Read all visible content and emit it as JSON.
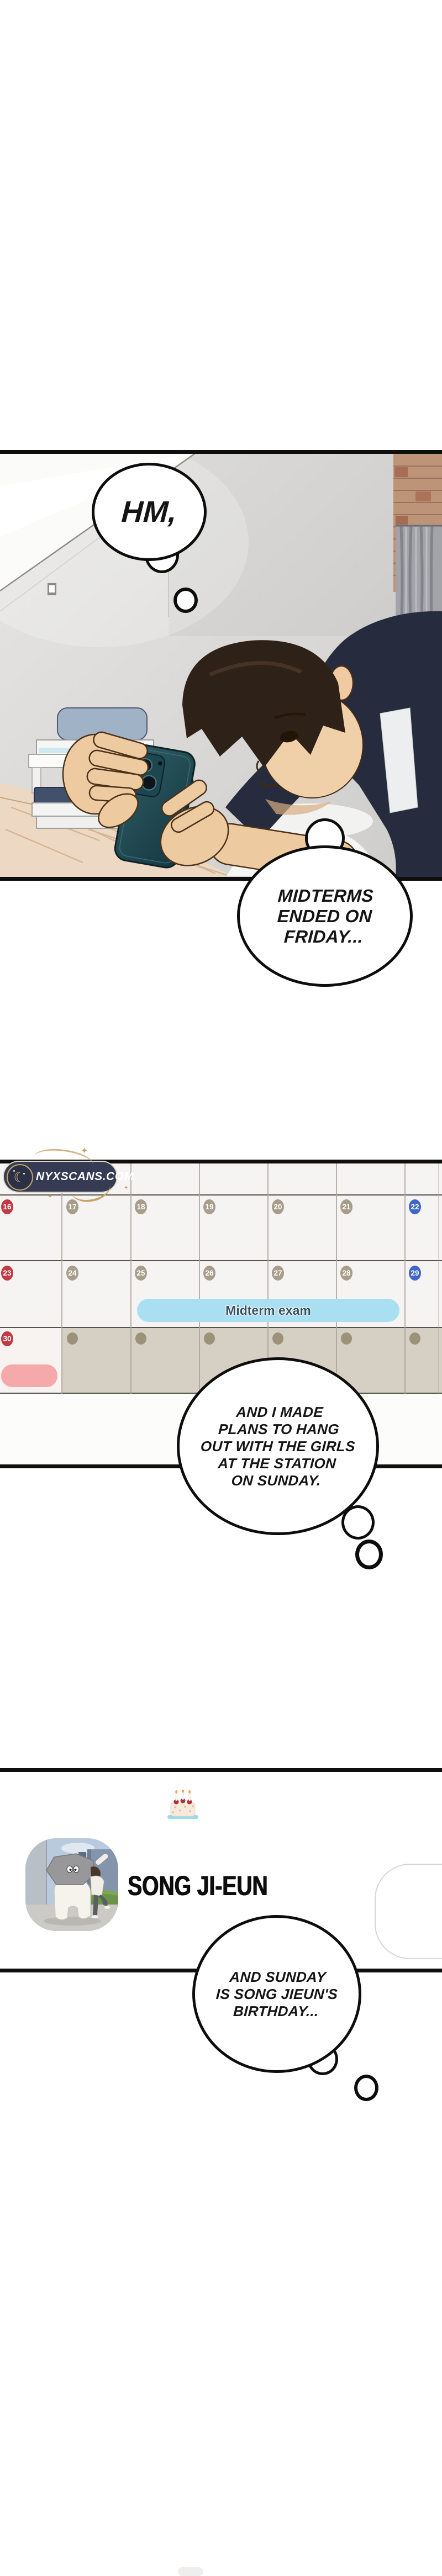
{
  "page": {
    "type": "webtoon-episode-page",
    "background": "#ffffff"
  },
  "watermark": {
    "text": "NYXSCANS.COM",
    "bg_color": "#343b53",
    "accent_color": "#c8a265"
  },
  "decor": {
    "sparkle": "✦"
  },
  "icons": {
    "moon": "☾"
  },
  "thoughts": {
    "hm": {
      "text": "HM,"
    },
    "midterms": {
      "line1": "MIDTERMS",
      "line2": "ENDED ON",
      "line3": "FRIDAY..."
    },
    "plans": {
      "line1": "AND I MADE",
      "line2": "PLANS TO HANG",
      "line3": "OUT WITH THE GIRLS",
      "line4": "AT THE STATION",
      "line5": "ON SUNDAY."
    },
    "birthday": {
      "line1": "AND SUNDAY",
      "line2": "IS SONG JIEUN'S",
      "line3": "BIRTHDAY..."
    }
  },
  "calendar": {
    "event": {
      "label": "Midterm exam",
      "color": "#aadff2",
      "text_color": "#33505e"
    },
    "holiday_pill_color": "#f5a9ab",
    "week1": {
      "d1": "16",
      "d2": "17",
      "d3": "18",
      "d4": "19",
      "d5": "20",
      "d6": "21",
      "d7": "22"
    },
    "week2": {
      "d1": "23",
      "d2": "24",
      "d3": "25",
      "d4": "26",
      "d5": "27",
      "d6": "28",
      "d7": "29"
    },
    "week3": {
      "d1": "30"
    },
    "colors": {
      "sunday": "#c23a44",
      "weekday": "#a79d8a",
      "saturday": "#3f66c9",
      "dimmed_row": "#d6cfc4",
      "cell": "#f5f4f2",
      "next_month_dot": "#9c9179"
    }
  },
  "contact": {
    "name": "SONG JI-EUN",
    "icon": "birthday-cake-icon"
  }
}
